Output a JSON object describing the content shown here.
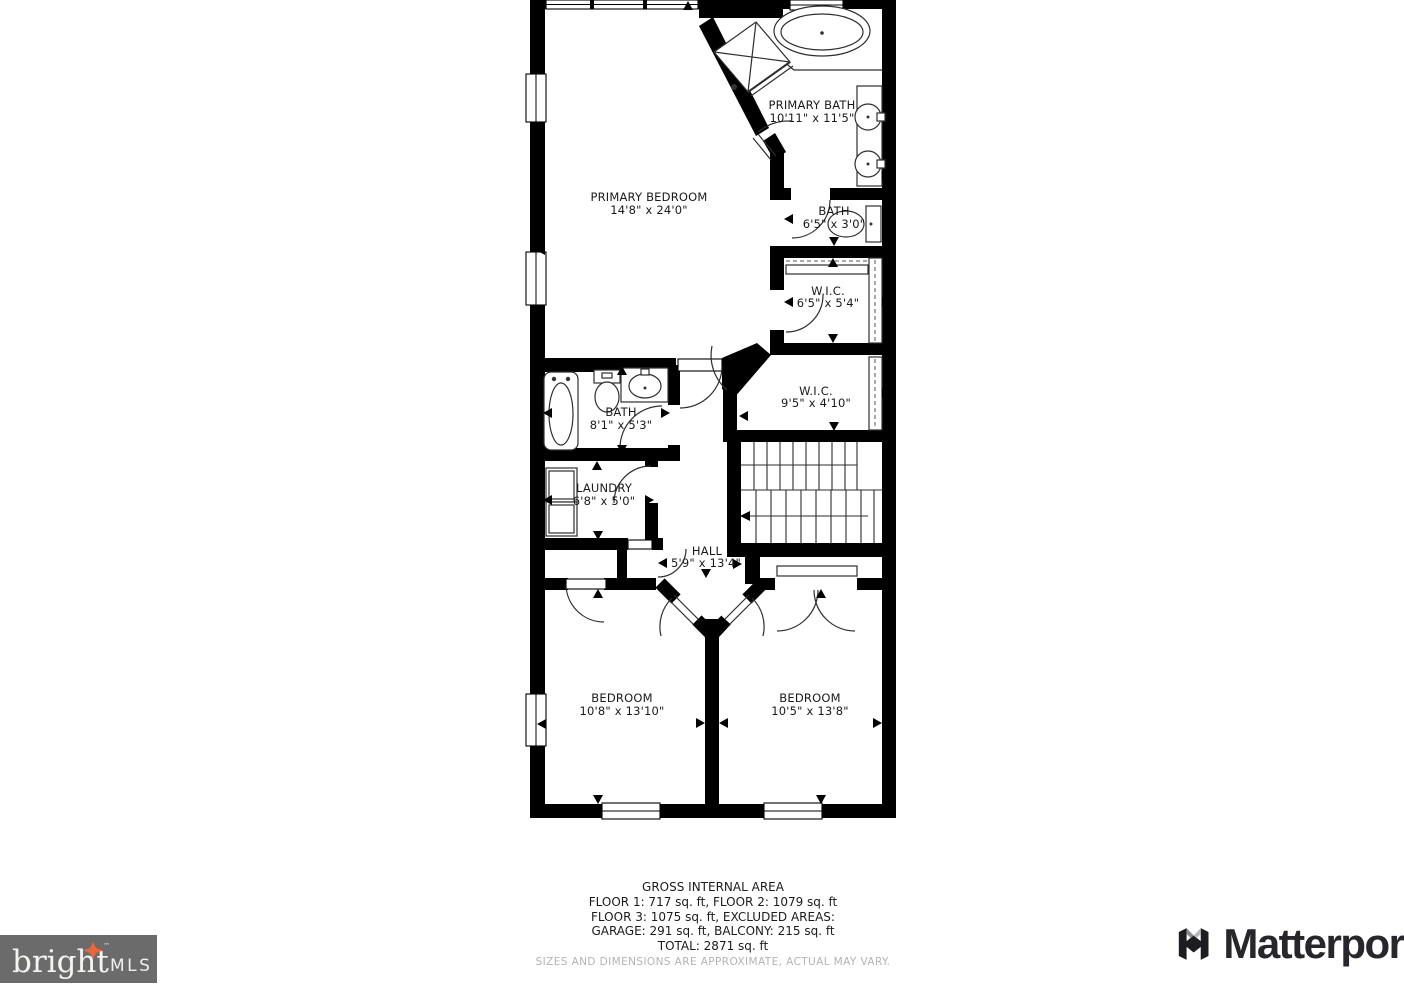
{
  "plan": {
    "rooms": [
      {
        "name": "PRIMARY BEDROOM",
        "dims": "14'8\" x 24'0\""
      },
      {
        "name": "PRIMARY BATH",
        "dims": "10'11\" x 11'5\""
      },
      {
        "name": "BATH",
        "dims": "6'5\" x 3'0\""
      },
      {
        "name": "W.I.C.",
        "dims": "6'5\" x 5'4\""
      },
      {
        "name": "W.I.C.",
        "dims": "9'5\" x 4'10\""
      },
      {
        "name": "BATH",
        "dims": "8'1\" x 5'3\""
      },
      {
        "name": "LAUNDRY",
        "dims": "6'8\" x 5'0\""
      },
      {
        "name": "HALL",
        "dims": "5'9\" x 13'4\""
      },
      {
        "name": "BEDROOM",
        "dims": "10'8\" x 13'10\""
      },
      {
        "name": "BEDROOM",
        "dims": "10'5\" x 13'8\""
      }
    ],
    "wall_color": "#000000",
    "line_color": "#2e2e2e"
  },
  "footer": {
    "title": "GROSS INTERNAL AREA",
    "line2": "FLOOR 1: 717 sq. ft, FLOOR 2: 1079 sq. ft",
    "line3": "FLOOR 3: 1075 sq. ft, EXCLUDED AREAS:",
    "line4": "GARAGE: 291 sq. ft, BALCONY: 215 sq. ft",
    "line5": "TOTAL: 2871 sq. ft",
    "disclaimer": "SIZES AND DIMENSIONS ARE APPROXIMATE, ACTUAL MAY VARY."
  },
  "logos": {
    "bright": {
      "name": "bright",
      "suffix": "MLS",
      "tm": "™",
      "bg_color": "#6b6b6b",
      "star_color": "#e8673c",
      "text_color": "#ffffff"
    },
    "matterport": {
      "name": "Matterport",
      "text_color": "#26262c"
    }
  }
}
